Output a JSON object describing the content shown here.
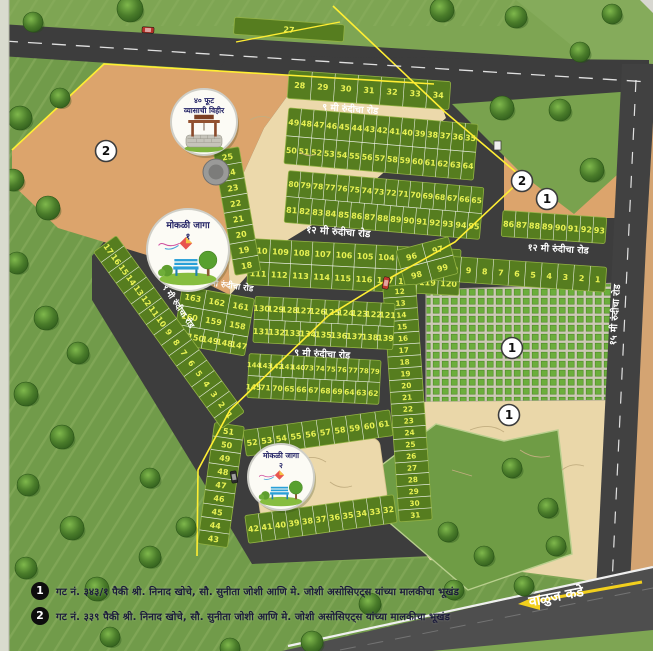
{
  "map": {
    "road_labels": {
      "top_9m": "९ मी रुंदीचा रोड",
      "mid_12m": "१२ मी रुंदीचा रोड",
      "right_12m": "१२ मी रुंदीचा रोड",
      "central_9m": "९ मी रुंदीचा रोड",
      "junction_9m": "९ मी रुंदीचा रोड",
      "diagonal_9m": "९ मी रुंदीचा रोड",
      "main_15m": "१५ मी रुंदीचा रोड",
      "direction": "वाळुज कडे"
    },
    "callouts": {
      "well": {
        "lines": [
          "४० फूट",
          "व्यासाची विहीर"
        ]
      },
      "open_space_1": {
        "lines": [
          "मोकळी जागा",
          "१"
        ]
      },
      "open_space_2": {
        "lines": [
          "मोकळी जागा",
          "२"
        ]
      }
    },
    "markers": [
      "2",
      "2",
      "1",
      "1",
      "1"
    ],
    "plot_blocks": {
      "top_27": [
        [
          "27"
        ]
      ],
      "row_28_34": [
        [
          "28",
          "29",
          "30",
          "31",
          "32",
          "33",
          "34"
        ]
      ],
      "block_35_64": [
        [
          "49",
          "48",
          "47",
          "46",
          "45",
          "44",
          "43",
          "42",
          "41",
          "40",
          "39",
          "38",
          "37",
          "36",
          "35"
        ],
        [
          "50",
          "51",
          "52",
          "53",
          "54",
          "55",
          "56",
          "57",
          "58",
          "59",
          "60",
          "61",
          "62",
          "63",
          "64"
        ]
      ],
      "block_65_95": [
        [
          "80",
          "79",
          "78",
          "77",
          "76",
          "75",
          "74",
          "73",
          "72",
          "71",
          "70",
          "69",
          "68",
          "67",
          "66",
          "65"
        ],
        [
          "81",
          "82",
          "83",
          "84",
          "85",
          "86",
          "87",
          "88",
          "89",
          "90",
          "91",
          "92",
          "93",
          "94",
          "95"
        ]
      ],
      "block_86_93": [
        [
          "86",
          "87",
          "88",
          "89",
          "90",
          "91",
          "92",
          "93"
        ]
      ],
      "block_101_120": [
        [
          "110",
          "109",
          "108",
          "107",
          "106",
          "105",
          "104",
          "103",
          "102",
          "101"
        ],
        [
          "111",
          "112",
          "113",
          "114",
          "115",
          "116",
          "117",
          "118",
          "119",
          "120"
        ]
      ],
      "row_1_11": [
        [
          "11",
          "10",
          "9",
          "8",
          "7",
          "6",
          "5",
          "4",
          "3",
          "2",
          "1"
        ]
      ],
      "wedge_96_99": [
        [
          "96",
          "97"
        ],
        [
          "98",
          "99"
        ]
      ],
      "col_12_31": [
        [
          "12"
        ],
        [
          "13"
        ],
        [
          "14"
        ],
        [
          "15"
        ],
        [
          "16"
        ],
        [
          "17"
        ],
        [
          "18"
        ],
        [
          "19"
        ],
        [
          "20"
        ],
        [
          "21"
        ],
        [
          "22"
        ],
        [
          "23"
        ],
        [
          "24"
        ],
        [
          "25"
        ],
        [
          "26"
        ],
        [
          "27"
        ],
        [
          "28"
        ],
        [
          "29"
        ],
        [
          "30"
        ],
        [
          "31"
        ]
      ],
      "block_121_139": [
        [
          "130",
          "129",
          "128",
          "127",
          "126",
          "125",
          "124",
          "123",
          "122",
          "121"
        ],
        [
          "131",
          "132",
          "133",
          "134",
          "135",
          "136",
          "137",
          "138",
          "139"
        ]
      ],
      "wedge_147_163": [
        [
          "163",
          "162",
          "161"
        ],
        [
          "160",
          "159",
          "158"
        ],
        [
          "151",
          "150",
          "149",
          "148",
          "147"
        ]
      ],
      "block_140_ext": [
        [
          "144",
          "143",
          "142",
          "141",
          "140",
          "73",
          "74",
          "75",
          "76",
          "77",
          "78",
          "79"
        ],
        [
          "145",
          "71",
          "70",
          "65",
          "66",
          "67",
          "68",
          "69",
          "64",
          "63",
          "62"
        ]
      ],
      "ring_top_52_61": [
        [
          "52",
          "53",
          "54",
          "55",
          "56",
          "57",
          "58",
          "59",
          "60",
          "61"
        ]
      ],
      "ring_left_43_51": [
        [
          "51"
        ],
        [
          "50"
        ],
        [
          "49"
        ],
        [
          "48"
        ],
        [
          "47"
        ],
        [
          "46"
        ],
        [
          "45"
        ],
        [
          "44"
        ],
        [
          "43"
        ]
      ],
      "ring_bottom_32_42": [
        [
          "42",
          "41",
          "40",
          "39",
          "38",
          "37",
          "36",
          "35",
          "34",
          "33",
          "32"
        ]
      ],
      "strip_1_17": [
        [
          "17",
          "16",
          "15",
          "14",
          "13",
          "12",
          "11",
          "10",
          "9",
          "8",
          "7",
          "6",
          "5",
          "4",
          "3",
          "2",
          "1"
        ]
      ],
      "col_18_25": [
        [
          "25"
        ],
        [
          "24"
        ],
        [
          "23"
        ],
        [
          "22"
        ],
        [
          "21"
        ],
        [
          "20"
        ],
        [
          "19"
        ],
        [
          "18"
        ]
      ]
    }
  },
  "legend": {
    "items": [
      {
        "marker": "1",
        "text": "गट नं. ३४३/१ पैकी श्री. निनाद खोचे, सौ. सुनीता जोशी आणि मे. जोशी असोसिएट्स यांच्या मालकीचा भूखंड"
      },
      {
        "marker": "2",
        "text": "गट नं. ३३९ पैकी श्री. निनाद खोचे, सौ. सुनीता जोशी आणि मे. जोशी असोसिएट्स यांच्या मालकीचा भूखंड"
      }
    ]
  },
  "colors": {
    "plot_green": "#567d1f",
    "plot_number": "#e8f153",
    "road": "#3d3d3d",
    "road_main": "#4e4e4e",
    "tan_dark": "#dca46c",
    "sand_light": "#ecd9ab",
    "checker_green": "#6cae3c",
    "checker_bg": "#cdc9b6",
    "field_green": "#7ea553",
    "boundary_yellow": "#ffee33",
    "label_white": "#ffffff",
    "legend_text": "#1b1b3a",
    "arrow_yellow": "#f2cf1d"
  }
}
